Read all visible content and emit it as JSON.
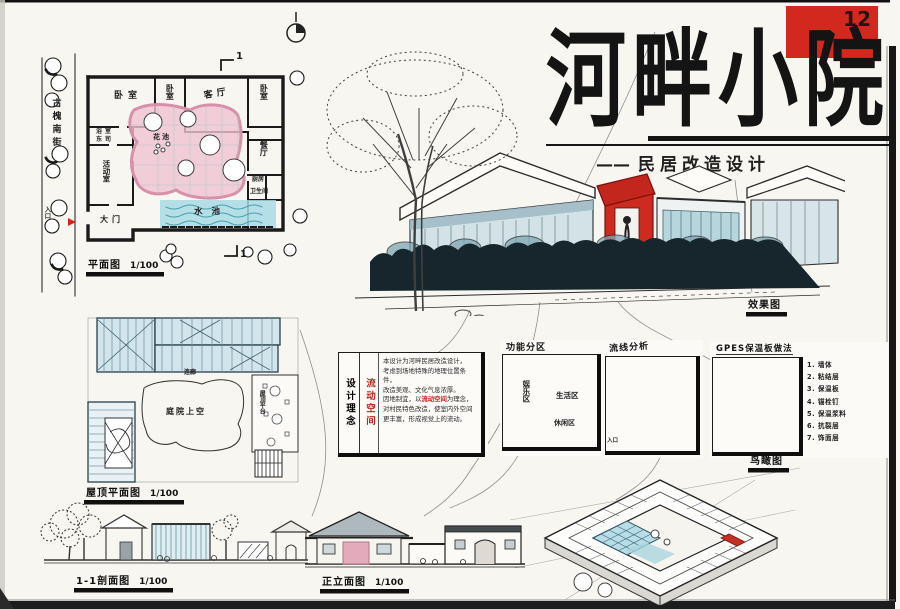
{
  "colors": {
    "accent_red": "#d2281e",
    "courtyard_pink": "#efc3d2",
    "water_blue": "#a9dbe4",
    "roof_blue": "#d3e5ec",
    "ink": "#1a1a1a",
    "vegetation": "#17252c"
  },
  "header": {
    "number": "12",
    "title": "河畔小院",
    "dash": "——",
    "subtitle": "民居改造设计"
  },
  "floor_plan": {
    "caption": "平面图",
    "scale": "1/100",
    "street": "古槐南街",
    "entrance": "入口",
    "section_mark": "1",
    "rooms": [
      "卧室",
      "卧室",
      "客厅",
      "卧室",
      "浴室",
      "东司",
      "餐厅",
      "厨房",
      "卫生间",
      "活动室",
      "大门",
      "花池",
      "水池"
    ]
  },
  "roof_plan": {
    "caption": "屋顶平面图",
    "scale": "1/100",
    "corridor": "连廊",
    "courtyard": "庭院上空",
    "terrace": "屋顶平台"
  },
  "perspective": {
    "caption": "效果图"
  },
  "concept": {
    "heading": "设计理念",
    "keyword": "流动空间",
    "p1": "本设计为河畔民居改造设计，",
    "p2": "考虑到场地特殊的地理位置条件，",
    "p3": "改造美观、文化气息浓厚。",
    "p4a": "因地制宜，以",
    "p4b": "流动空间",
    "p4c": "为理念，",
    "p5": "对村民特色改造，使室内外空间",
    "p6": "更丰富，形成视觉上的流动。"
  },
  "zoning": {
    "heading": "功能分区",
    "zone_left": "娱乐区",
    "zone_right": "生活区",
    "zone_bottom": "休闲区"
  },
  "circulation": {
    "heading": "流线分析",
    "entrance": "入口"
  },
  "construction": {
    "heading": "GPES保温板做法",
    "nums": [
      "1",
      "2",
      "3",
      "4",
      "5",
      "6",
      "7"
    ],
    "layers": [
      "1. 墙体",
      "2. 粘结层",
      "3. 保温板",
      "4. 锚栓钉",
      "5. 保温浆料",
      "6. 抗裂层",
      "7. 饰面层"
    ]
  },
  "axon": {
    "caption": "鸟瞰图"
  },
  "section": {
    "caption": "1-1剖面图",
    "scale": "1/100"
  },
  "elevation": {
    "caption": "正立面图",
    "scale": "1/100"
  }
}
